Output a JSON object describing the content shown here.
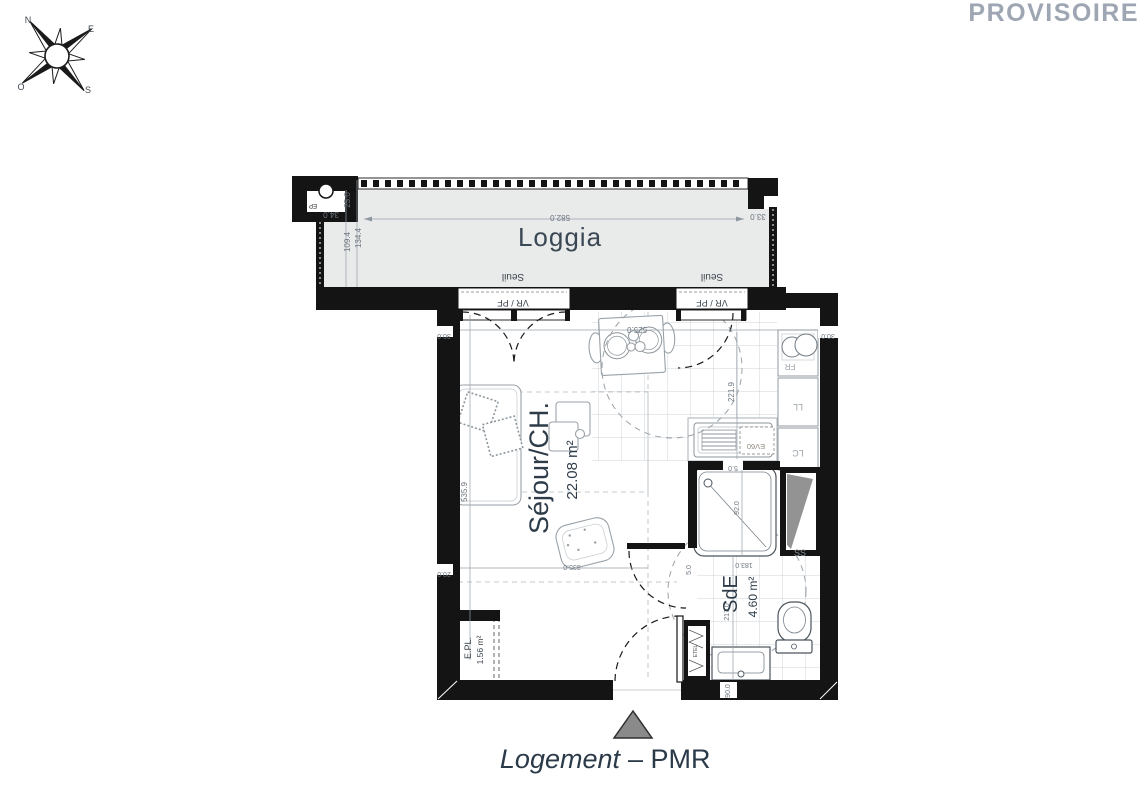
{
  "watermark": "PROVISOIRE",
  "compass": {
    "north": "N",
    "east": "E",
    "south": "S",
    "west": "O"
  },
  "rooms": {
    "loggia": {
      "name": "Loggia"
    },
    "sejour": {
      "name": "Séjour/CH.",
      "area": "22.08 m²"
    },
    "sde": {
      "name": "SdE",
      "area": "4.60 m²"
    },
    "epl": {
      "name": "E.PL.",
      "area": "1.56 m²"
    }
  },
  "openings": {
    "seuil": "Seuil",
    "vr_pf": "VR / PF"
  },
  "fixtures": {
    "ep": "EP",
    "fr": "FR",
    "ll": "LL",
    "lc": "LC",
    "ev": "EV60",
    "ss": "SS",
    "etel": "ETEL"
  },
  "dims": {
    "d582": "582.0",
    "d33": "33.0",
    "d34": "34.0",
    "d25": "25.0",
    "d109": "109.4",
    "d134": "134.4",
    "d30_left": "30.0",
    "d30_right": "30.0",
    "d525": "525.0",
    "d535": "535.9",
    "d221": "221.9",
    "d20": "20.0",
    "d335": "335.0",
    "d5_top": "5.0",
    "d5_door": "5.0",
    "d92": "92.0",
    "d183": "183.0",
    "d217": "217.0",
    "d90": "90.0"
  },
  "footer": {
    "name": "Logement",
    "type": "– PMR"
  }
}
